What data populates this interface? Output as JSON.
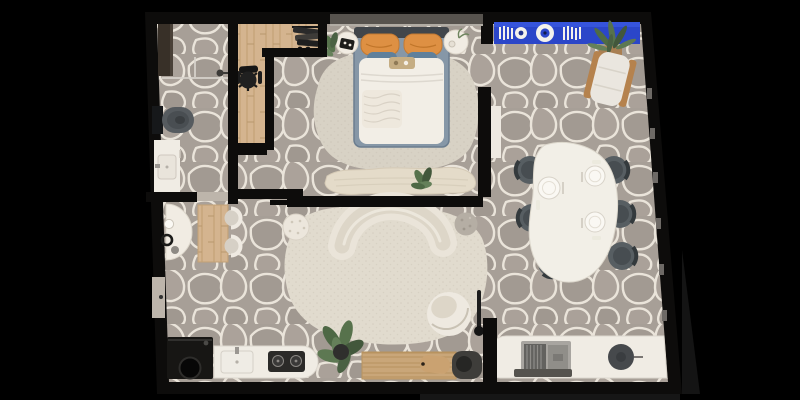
{
  "scene": {
    "title": "apartment-floor-plan-3d-render",
    "view": "top-down",
    "background": "#000000"
  },
  "palette": {
    "wall": "#0d0c0b",
    "stone": "#a79f97",
    "crack": "#eae4da",
    "wood": "#d4b48f",
    "benchwood": "#c9a679",
    "rugbedroom": "#d8d2c5",
    "rugliving": "#e1dbce",
    "bedframe": "#8697a7",
    "headboard": "#41464b",
    "duvet": "#f2eee6",
    "piloworange": "#de9043",
    "pillowblue": "#60809b",
    "shelfblue": "#2b46c9",
    "sofa": "#eae4d9",
    "tablewhite": "#f2efe7",
    "chairdark": "#575e62",
    "counter": "#f0ece4",
    "appliance": "#171614",
    "plantgreen": "#57724c",
    "fixture": "#565b5f",
    "cream": "#f1ece3",
    "windowband": "#57534e",
    "doorleaf": "#bdb5ab"
  },
  "rooms": [
    {
      "id": "bathroom",
      "furniture": [
        "wardrobe",
        "shower-glass",
        "wall-hung-toilet",
        "vanity-sink"
      ]
    },
    {
      "id": "entry-closet-hall",
      "furniture": [
        "clothes-rack",
        "black-desk-chair",
        "wood-floor"
      ]
    },
    {
      "id": "bedroom",
      "furniture": [
        "double-bed",
        "orange-pillows",
        "blue-pillows",
        "nightstand-left",
        "nightstand-right",
        "organic-rug",
        "foot-bench",
        "bench-plant",
        "window-band"
      ]
    },
    {
      "id": "reading-corner",
      "furniture": [
        "blue-wall-shelf",
        "books",
        "decor-discs",
        "potted-plant",
        "wood-lounge-chair"
      ]
    },
    {
      "id": "dining-area",
      "furniture": [
        "organic-dining-table",
        "place-settings-x3",
        "dark-chairs-x6",
        "wall-console"
      ]
    },
    {
      "id": "living-room",
      "furniture": [
        "curved-kidney-sofa",
        "organic-rug",
        "quilted-pouf",
        "stone-ball-pouf",
        "swivel-armchair",
        "floor-lamp",
        "monstera-plant"
      ]
    },
    {
      "id": "kitchen",
      "furniture": [
        "washing-machine",
        "white-counter",
        "sink",
        "cooktop-2-burners",
        "wood-bench",
        "cutting-board",
        "dark-mat-stool"
      ]
    },
    {
      "id": "work-nook",
      "furniture": [
        "white-desk",
        "laptop",
        "round-stool"
      ]
    },
    {
      "id": "hall-nook",
      "furniture": [
        "demilune-table",
        "vase-decor",
        "wood-table",
        "white-chairs-x2",
        "entry-door"
      ]
    }
  ]
}
